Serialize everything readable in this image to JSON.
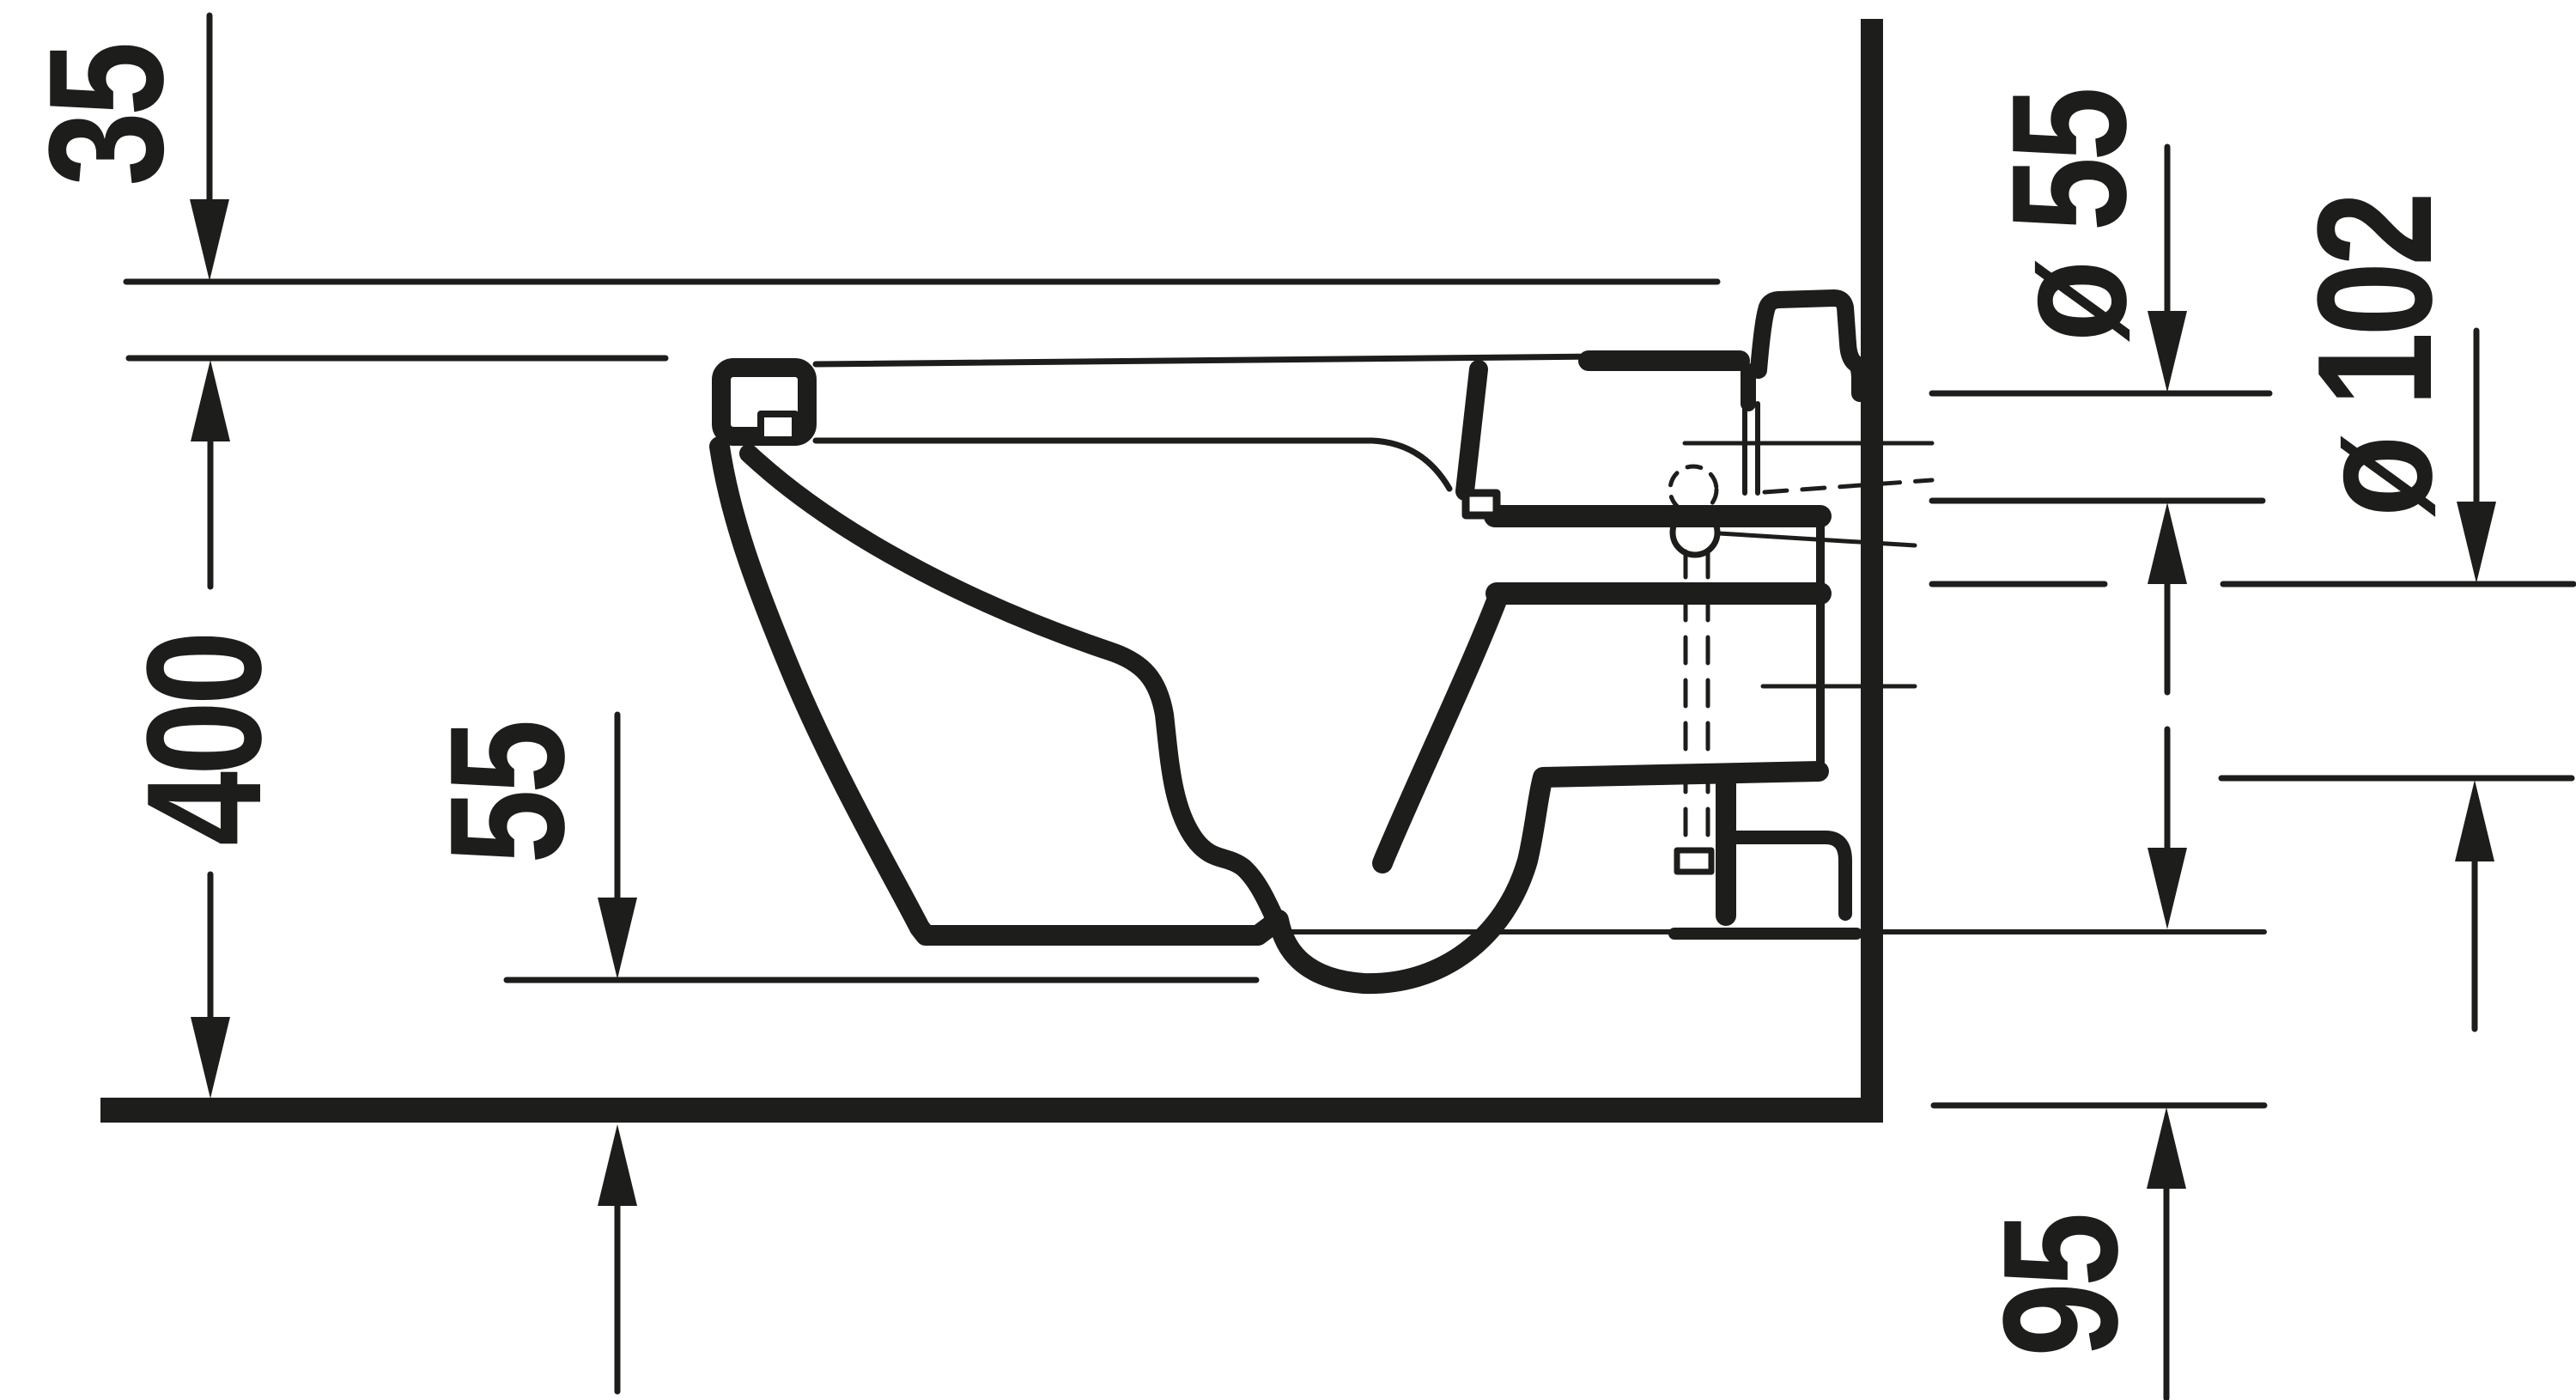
{
  "colors": {
    "ink": "#1d1d1b",
    "background": "#ffffff"
  },
  "labels": {
    "dim_35": "35",
    "dim_400": "400",
    "dim_55": "55",
    "dim_dia55": "ø 55",
    "dim_dia102": "ø 102",
    "dim_95": "95"
  }
}
